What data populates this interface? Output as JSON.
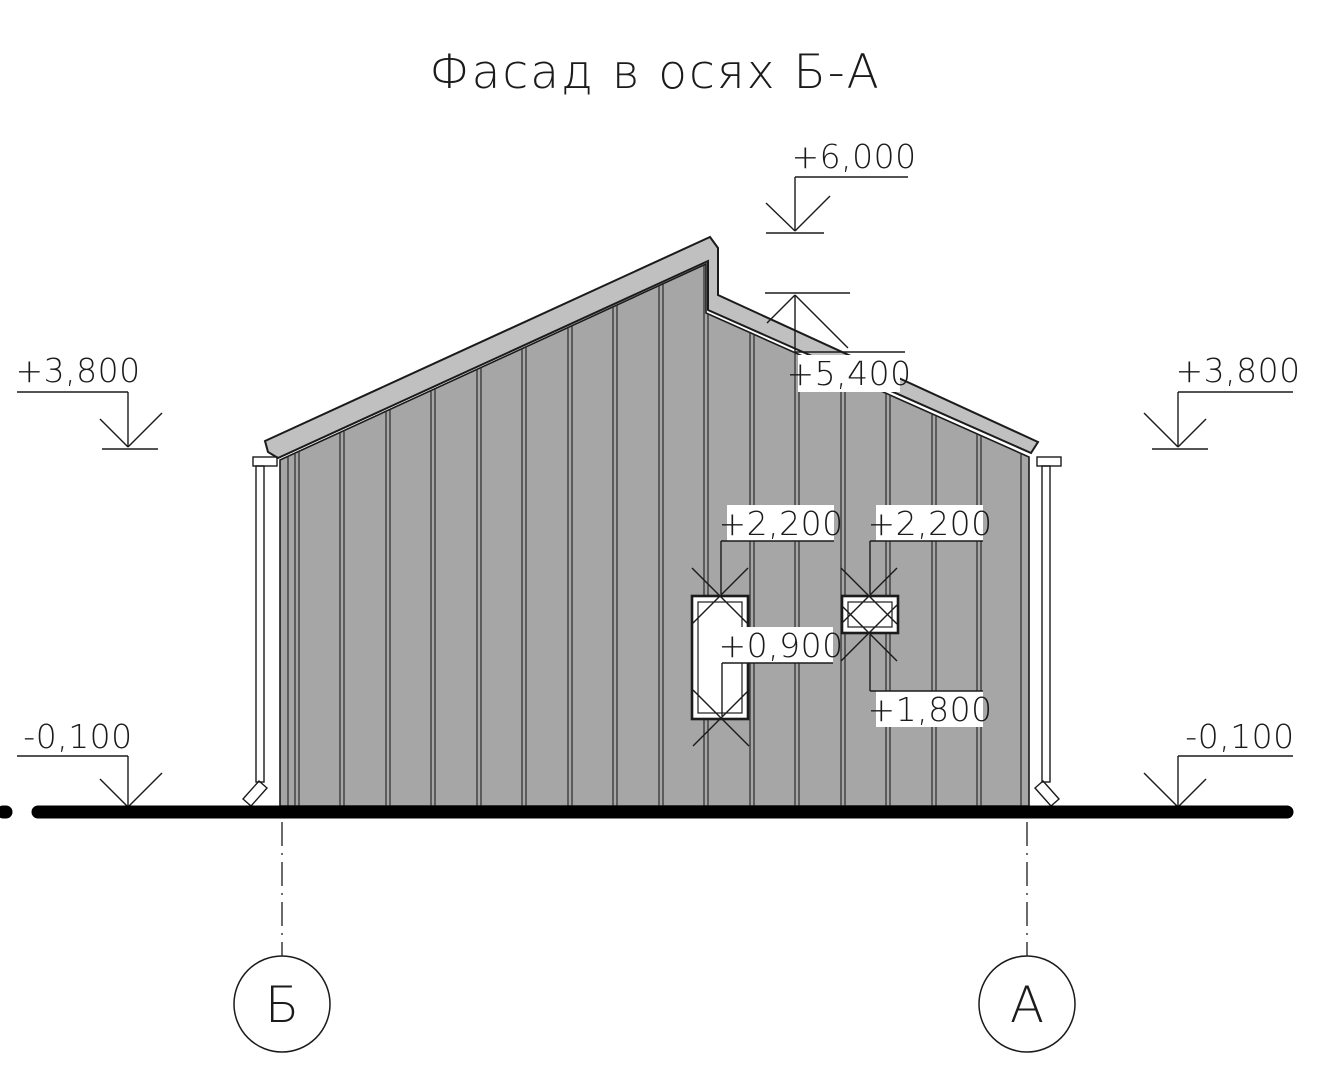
{
  "title": "Фасад в осях Б-А",
  "drawing_type": "facade-elevation",
  "axis_markers": {
    "left": "Б",
    "right": "А"
  },
  "elevation_marks": {
    "ridge": "+6,000",
    "roof_step": "+5,400",
    "eave_left": "+3,800",
    "eave_right": "+3,800",
    "door_head": "+2,200",
    "window_head": "+2,200",
    "door_sill": "+0,900",
    "window_sill": "+1,800",
    "ground_left": "-0,100",
    "ground_right": "-0,100"
  },
  "colors": {
    "wall": "#a6a6a6",
    "roof_band": "#c0c0c0",
    "line": "#1b1b1b",
    "ground_line": "#000000",
    "label_background": "#ffffff"
  }
}
